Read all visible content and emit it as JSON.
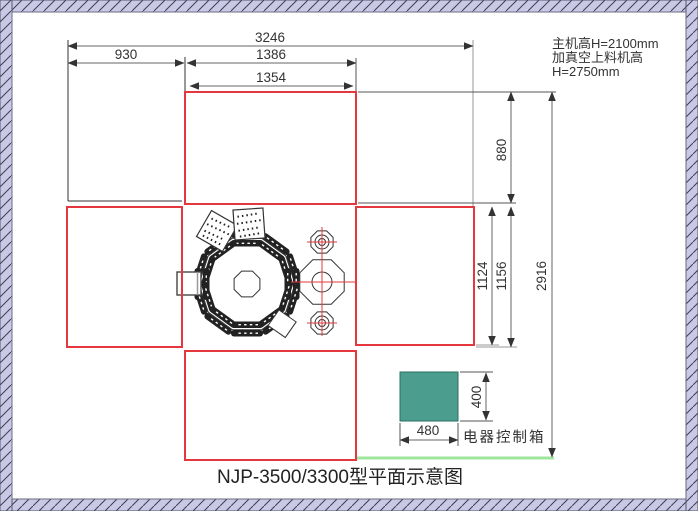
{
  "drawing": {
    "title": "NJP-3500/3300型平面示意图",
    "notes": [
      "主机高H=2100mm",
      "加真空上料机高",
      "H=2750mm"
    ],
    "control_box_label": "电器控制箱",
    "dims": {
      "total_width": "3246",
      "feeder_width": "930",
      "main_width": "1386",
      "inner_width": "1354",
      "top_depth": "880",
      "mid_depth_inner": "1124",
      "mid_depth_outer": "1156",
      "total_depth": "2916",
      "box_width": "480",
      "box_height": "400"
    },
    "colors": {
      "red": "#e5383e",
      "teal": "#4b9d8d",
      "green": "#9ce79c",
      "hatch_fill": "#c9c9e6",
      "hatch_line": "#3d3d55",
      "machine": "#222222"
    }
  }
}
